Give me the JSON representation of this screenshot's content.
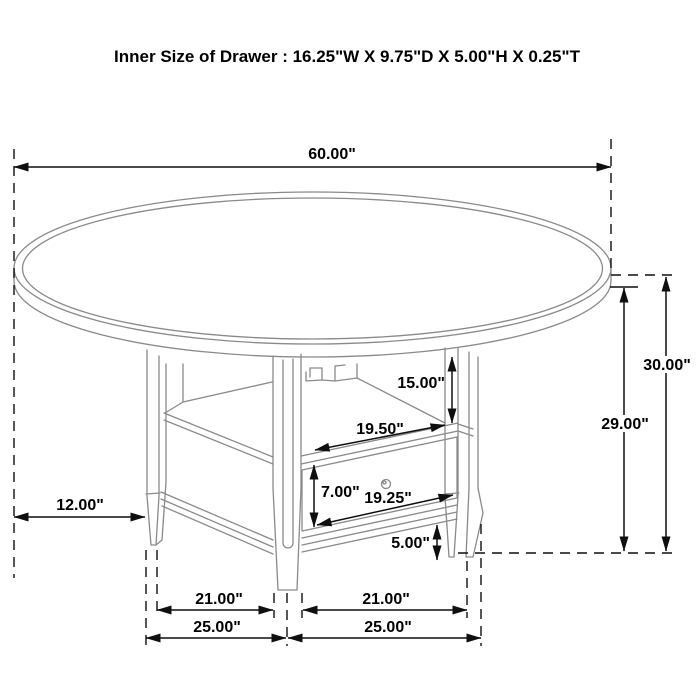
{
  "title": "Inner Size of Drawer : 16.25\"W X 9.75\"D X 5.00\"H X 0.25\"T",
  "dims": {
    "diameter": "60.00\"",
    "total_height": "30.00\"",
    "underside_height": "29.00\"",
    "compartment_height": "15.00\"",
    "compartment_width": "19.50\"",
    "drawer_front_height": "7.00\"",
    "drawer_front_width": "19.25\"",
    "bottom_clearance": "5.00\"",
    "top_overhang": "12.00\"",
    "left_leg_inner_span": "21.00\"",
    "right_leg_inner_span": "21.00\"",
    "left_leg_outer_span": "25.00\"",
    "right_leg_outer_span": "25.00\""
  },
  "colors": {
    "background": "#ffffff",
    "drawing_line": "#8a8a8a",
    "dimension_line": "#0f0f0f",
    "text": "#000000"
  }
}
